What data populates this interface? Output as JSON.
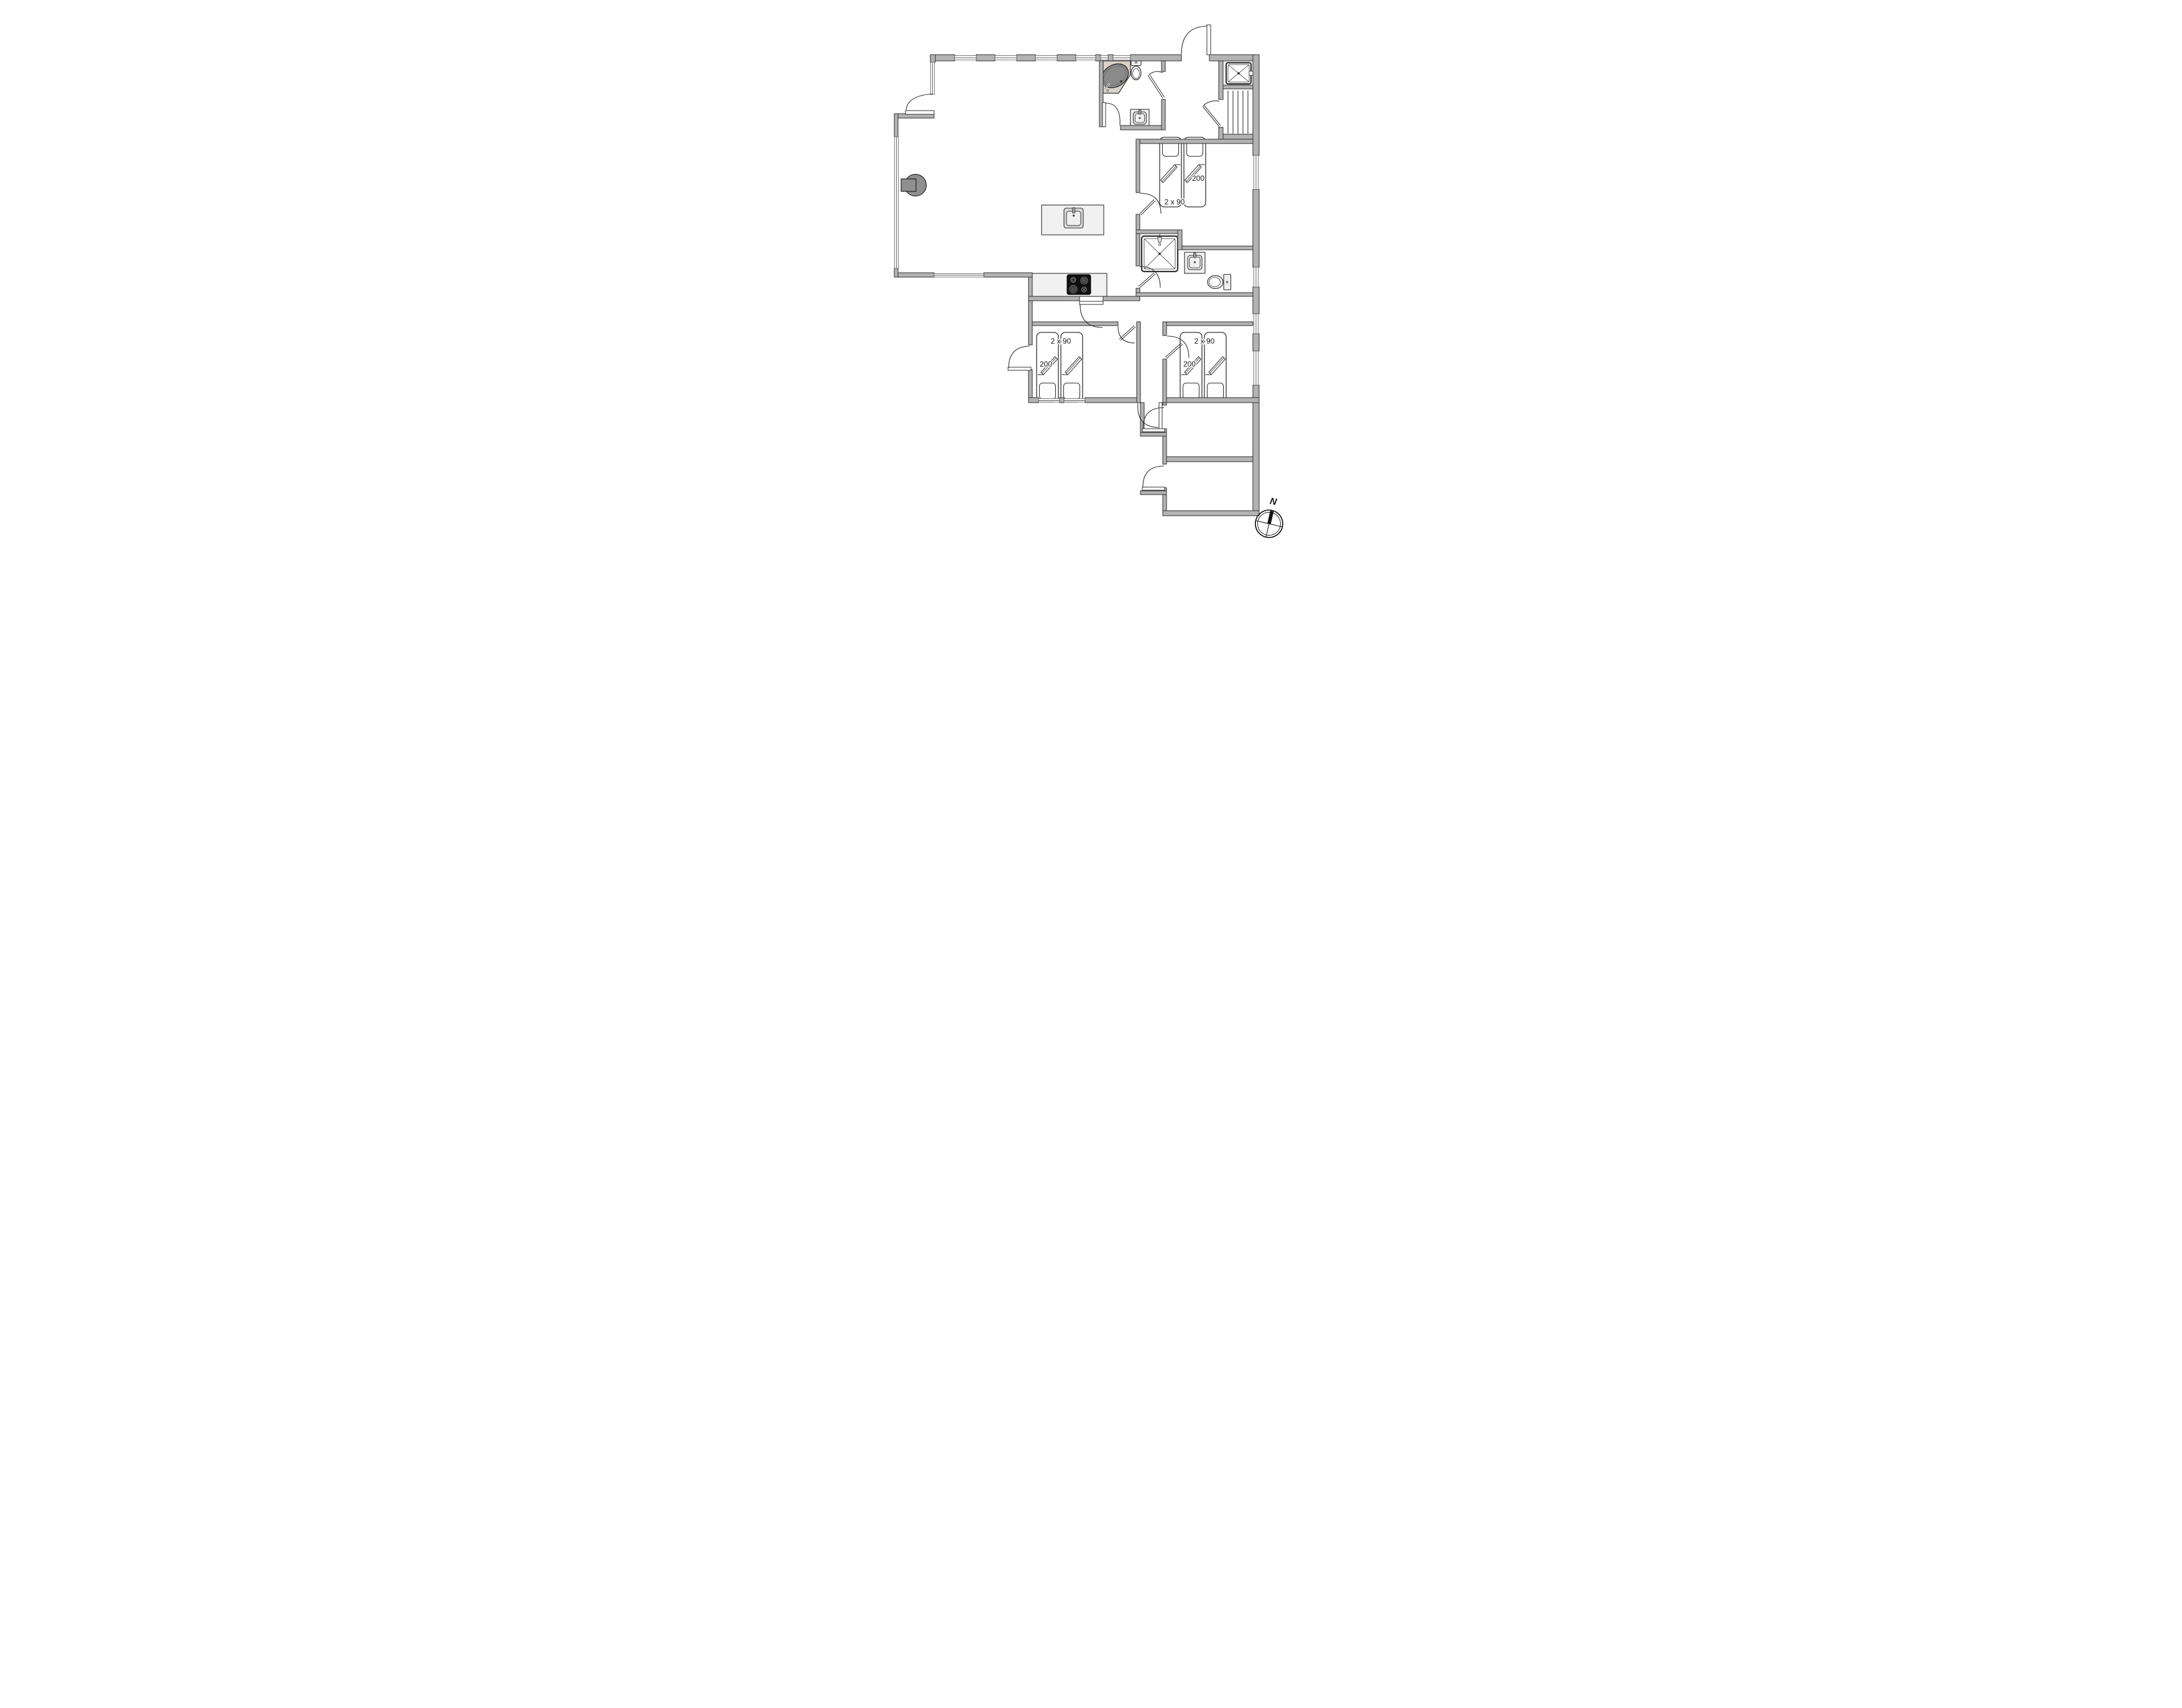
{
  "floor_plan": {
    "type": "holiday-house floor plan",
    "compass": {
      "north_label": "N"
    },
    "bedrooms": [
      {
        "id": "bedroom-northeast",
        "bed_size_label": "2 x 90",
        "bed_length_label": "200"
      },
      {
        "id": "bedroom-southwest",
        "bed_size_label": "2 x 90",
        "bed_length_label": "200"
      },
      {
        "id": "bedroom-southeast",
        "bed_size_label": "2 x 90",
        "bed_length_label": "200"
      }
    ],
    "fixtures": {
      "main_bathroom": [
        "corner-bathtub",
        "toilet",
        "hand-sink"
      ],
      "ensuite_bathroom": [
        "shower",
        "hand-sink",
        "toilet"
      ],
      "entry_area": [
        "shower-cabin",
        "stairs"
      ],
      "kitchen": [
        "island-sink",
        "cooktop",
        "counter"
      ],
      "living_room": [
        "wood-stove"
      ],
      "annex": [
        "storage-room",
        "storage-room"
      ]
    },
    "colors": {
      "wall": "#b3b3b3",
      "wall_outline": "#2f2f2f",
      "fixture_dark": "#8a8a8a",
      "tub_platform": "#d8d2c8",
      "counter_light": "#f1f1f1",
      "cooktop": "#111111",
      "label_text": "#16181c"
    }
  }
}
